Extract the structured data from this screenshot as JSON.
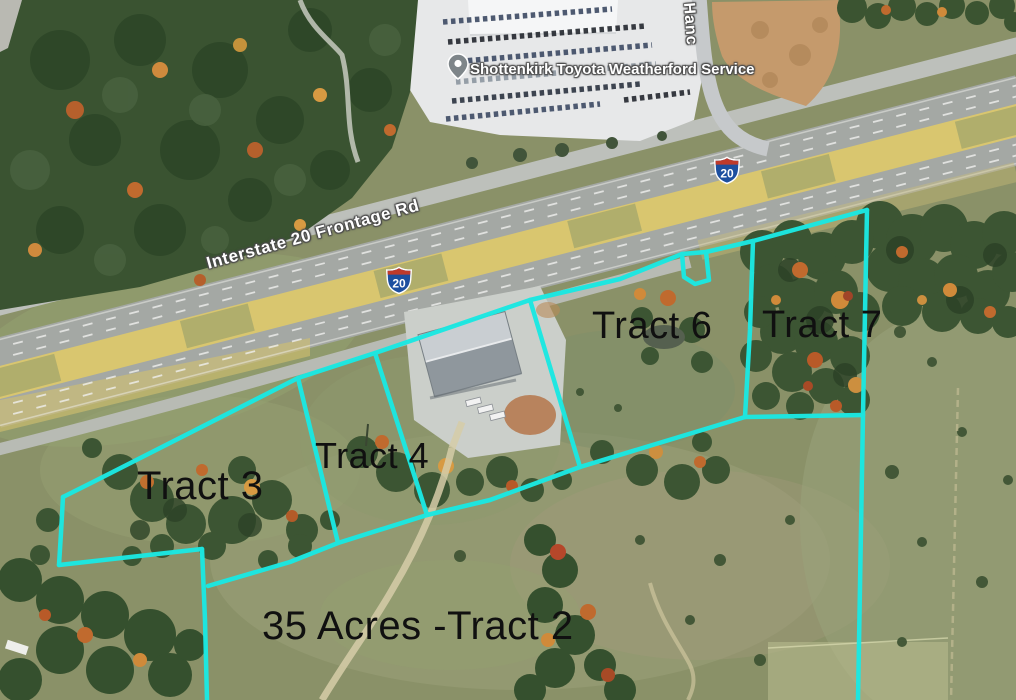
{
  "map": {
    "poi": {
      "name": "Shottenkirk Toyota Weatherford Service",
      "icon": "map-pin-icon"
    },
    "road_labels": {
      "frontage": "Interstate 20 Frontage Rd",
      "hancock_partial": "Hanc"
    },
    "interstate_shields": [
      {
        "route": "20"
      },
      {
        "route": "20"
      }
    ],
    "tract_labels": {
      "tract3": "Tract 3",
      "tract4": "Tract 4",
      "tract6": "Tract 6",
      "tract7": "Tract 7",
      "tract2": "35 Acres -Tract 2"
    },
    "colors": {
      "boundary_line": "#1be8e2",
      "tract_label_text": "#101010",
      "map_label_text": "#ffffff",
      "map_label_halo": "#4a4a4a",
      "median_tan": "#d9c66f",
      "shield_blue": "#1d4f9f",
      "shield_red": "#bf3a2b"
    }
  }
}
